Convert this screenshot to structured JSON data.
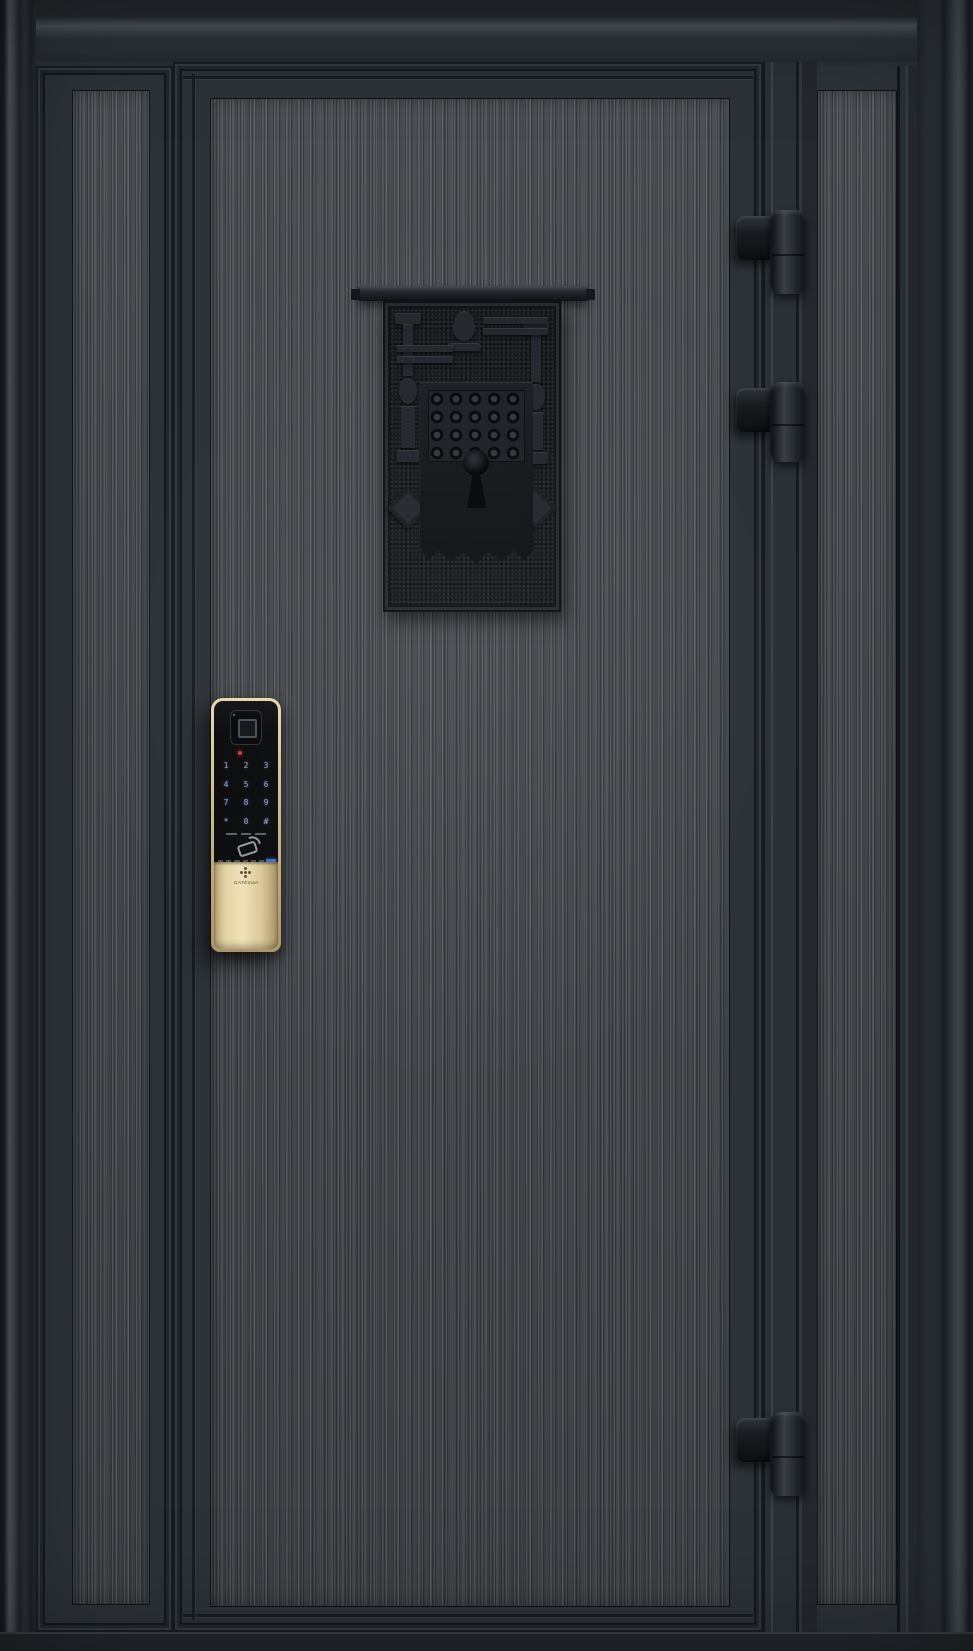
{
  "scene": {
    "type": "product-photo",
    "subject": "Dark charcoal steel security entry door (leaf-and-a-half) with textured wood-grain panels, antique keyhole plaque, push-pull smart lock and three barrel hinges"
  },
  "palette": {
    "frame": "#272c31",
    "stile": "#2b3036",
    "panel_texture_base": "#43474b",
    "plaque_background": "#16181b",
    "lock_body": "#0b0c0e",
    "lock_trim_gold": "#d7c496",
    "keypad_glow": "#9db0da",
    "indicator_red": "#d03a30",
    "reader_chip_blue": "#3f6fd1"
  },
  "smart_lock": {
    "brand_label": "GATEman",
    "keypad": {
      "keys": [
        "1",
        "2",
        "3",
        "4",
        "5",
        "6",
        "7",
        "8",
        "9",
        "*",
        "0",
        "#"
      ]
    }
  },
  "plaque": {
    "motif": "antique escutcheon with scrollwork and keyhole"
  },
  "hinges": {
    "count": 3
  }
}
